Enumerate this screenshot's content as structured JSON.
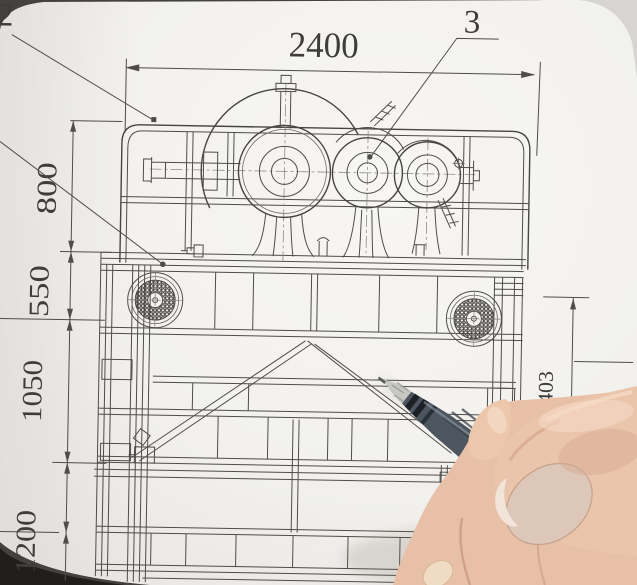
{
  "drawing": {
    "dim_top": "2400",
    "dim_left": [
      "800",
      "550",
      "1050",
      "1200"
    ],
    "dim_right": "1403",
    "callout_top": "3",
    "callout_left": "2"
  },
  "colors": {
    "paper": "#f3f2ee",
    "ink": "#4f4d4a",
    "pen_body": "#4d565f",
    "pen_band": "#1c2126",
    "skin": "#e7c0a7",
    "background": "#44423f"
  }
}
